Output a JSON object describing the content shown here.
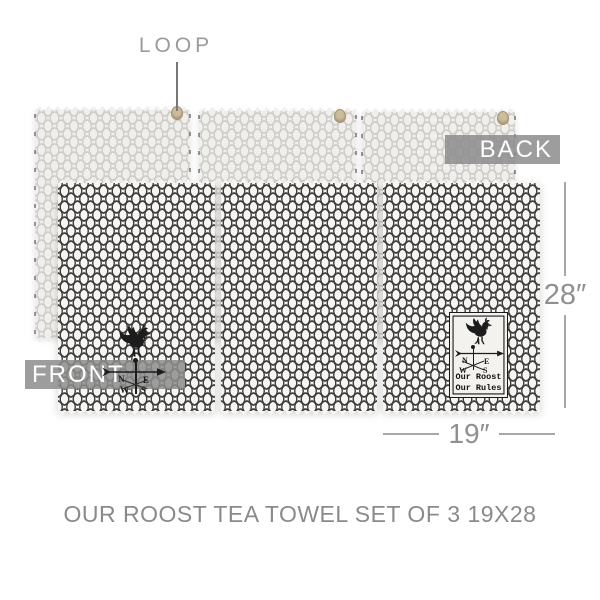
{
  "caption": "OUR ROOST TEA TOWEL SET OF 3 19X28",
  "callouts": {
    "loop": "LOOP",
    "back": "BACK",
    "front": "FRONT"
  },
  "dimensions": {
    "height": "28″",
    "width": "19″"
  },
  "vane": {
    "compass": {
      "n": "N",
      "e": "E",
      "w": "W",
      "s": "S"
    }
  },
  "stamp": {
    "line1": "Our Roost",
    "line2": "Our Rules",
    "compass": {
      "n": "N",
      "e": "E",
      "w": "W",
      "s": "S"
    }
  },
  "colors": {
    "wire_front": "#3f3f3f",
    "fabric_front": "#f6f5f2",
    "wire_back": "#cfcecb",
    "fabric_back": "#f0efec",
    "banner_gray": "#8d8d8d",
    "annotation_gray": "#8f8f8f",
    "hang_loop_tan": "#cdbd9b",
    "stamp_ink": "#1a1a1a"
  }
}
